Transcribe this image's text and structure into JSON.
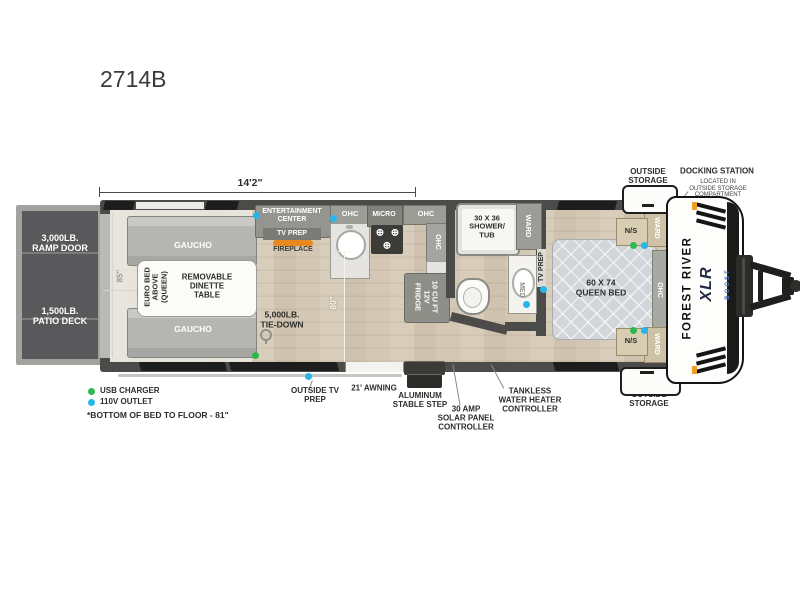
{
  "model": "2714B",
  "dimensions": {
    "length": "14'2\"",
    "garage_width": "85\"",
    "galley": "80\""
  },
  "ramp": {
    "door": "3,000LB.\nRAMP DOOR",
    "patio": "1,500LB.\nPATIO DECK"
  },
  "garage": {
    "gaucho": "GAUCHO",
    "euro_bed": "EURO BED\nABOVE\n(QUEEN)",
    "dinette": "REMOVABLE\nDINETTE\nTABLE",
    "tie_down": "5,000LB.\nTIE-DOWN"
  },
  "kitchen": {
    "entertainment": "ENTERTAINMENT\nCENTER",
    "tv_prep": "TV PREP",
    "fireplace": "FIREPLACE",
    "ohc": "OHC",
    "micro": "MICRO",
    "fridge": "10 CU FT\n12V\nFRIDGE"
  },
  "bath": {
    "shower": "30 X 36\nSHOWER/\nTUB",
    "ward": "WARD",
    "med": "MED"
  },
  "bedroom": {
    "bed": "60 X 74\nQUEEN BED",
    "ns": "N/S",
    "ward": "WARD",
    "ohc": "OHC",
    "tv_prep": "TV PREP"
  },
  "exterior": {
    "outside_storage": "OUTSIDE\nSTORAGE",
    "docking_station": "DOCKING STATION",
    "docking_note": "LOCATED IN\nOUTSIDE STORAGE\nCOMPARTMENT",
    "awning": "21' AWNING",
    "step": "ALUMINUM\nSTABLE STEP",
    "solar": "30 AMP\nSOLAR PANEL\nCONTROLLER",
    "tankless": "TANKLESS\nWATER HEATER\nCONTROLLER",
    "outside_tv": "OUTSIDE TV\nPREP"
  },
  "branding": {
    "make": "FOREST RIVER",
    "series": "XLR",
    "series_sub": "BOOST"
  },
  "legend": {
    "usb": "USB CHARGER",
    "outlet": "110V OUTLET",
    "note": "*BOTTOM OF BED TO FLOOR - 81\""
  },
  "colors": {
    "usb_green": "#2db84d",
    "outlet_blue": "#26b7ea",
    "fireplace_orange": "#e8891f",
    "wall_gray": "#4b4b49"
  }
}
